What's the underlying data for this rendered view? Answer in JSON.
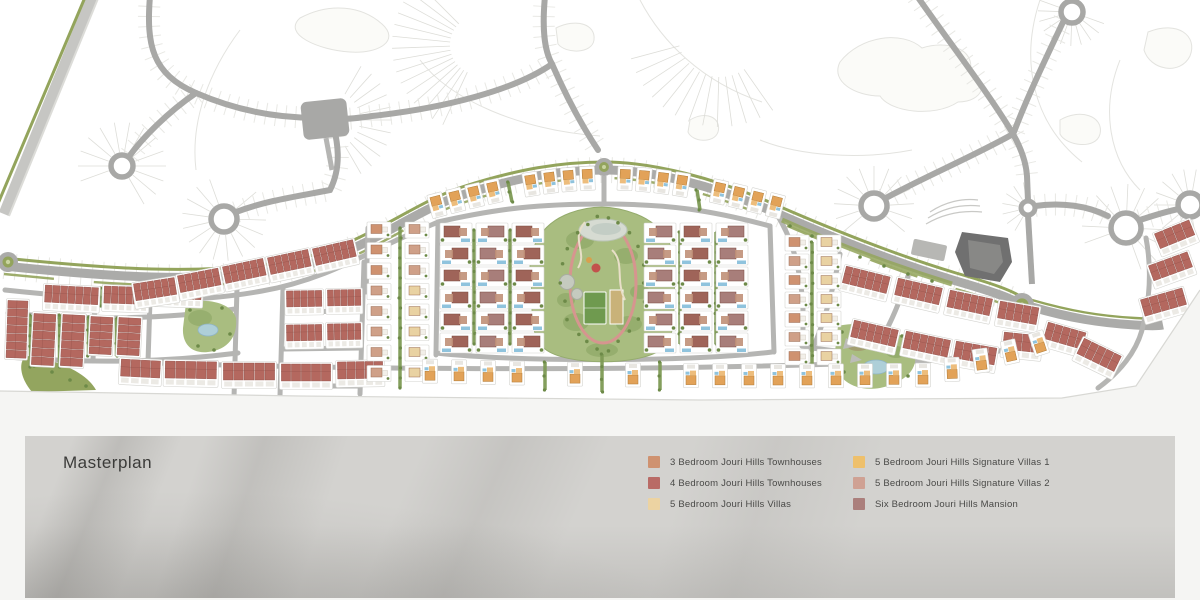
{
  "page": {
    "background": "#f5f5f3"
  },
  "map": {
    "name": "Jouri Hills masterplan site plan",
    "colors": {
      "site_bg": "#ffffff",
      "contour": "#e3e3df",
      "plot_line": "#ddddd8",
      "road": "#a8a8a6",
      "road_minor": "#b5b5b3",
      "highway": "#c6c6c3",
      "green_verge": "#93a45c",
      "hedge_green": "#7e9a55",
      "tree_green": "#6d8a48",
      "park_green": "#a9bd80",
      "park_blotch": "#90a968",
      "pond_blue": "#aecfd8",
      "pond_gray": "#d6dbd2",
      "pool_blue": "#8fc3dd",
      "field_green": "#6f9a4f",
      "court_tan": "#c9b279",
      "track_pink": "#d6958f",
      "townhouse_3br": "#cf9270",
      "townhouse_4br": "#b4685f",
      "villa_5br": "#e9d2a2",
      "signature_villa_1": "#e2a258",
      "signature_villa_1_light": "#edbd7c",
      "signature_villa_2": "#cfa088",
      "mansion_6br": "#a87e7a",
      "mansion_red": "#9f6459",
      "clubhouse_dark": "#707070",
      "clubhouse_light": "#8c8c8a",
      "plot_stroke": "#d4d4d0",
      "boundary_line": "#d8d8d4"
    }
  },
  "footer": {
    "title": "Masterplan",
    "background": "#d3d2cf",
    "legend": {
      "columns": [
        {
          "items": [
            {
              "label": "3 Bedroom Jouri Hills Townhouses",
              "color": "#cf9270"
            },
            {
              "label": "4 Bedroom Jouri Hills Townhouses",
              "color": "#b96b66"
            },
            {
              "label": "5 Bedroom Jouri Hills Villas",
              "color": "#ecd3a2"
            }
          ]
        },
        {
          "items": [
            {
              "label": "5 Bedroom Jouri Hills Signature Villas 1",
              "color": "#eec06c"
            },
            {
              "label": "5 Bedroom Jouri Hills Signature Villas 2",
              "color": "#cfa193"
            },
            {
              "label": "Six Bedroom Jouri Hills Mansion",
              "color": "#ab7f7c"
            }
          ]
        }
      ]
    }
  }
}
